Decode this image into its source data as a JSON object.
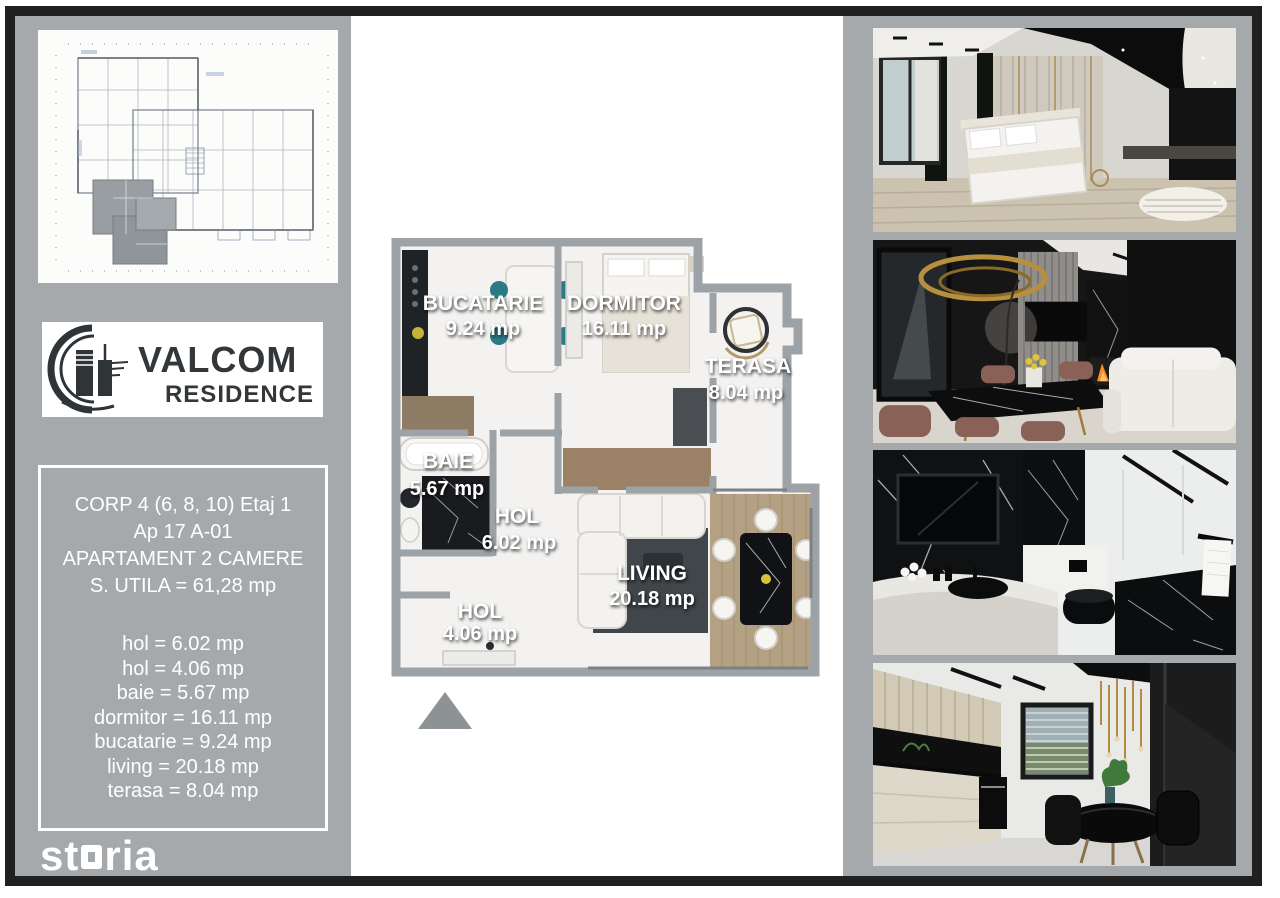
{
  "branding": {
    "logo_line1": "VALCOM",
    "logo_line2": "RESIDENCE"
  },
  "watermark": {
    "full": "storia",
    "part1": "st",
    "part2": "ria"
  },
  "info_box": {
    "line1": "CORP 4 (6, 8, 10) Etaj 1",
    "line2": "Ap 17 A-01",
    "line3": "APARTAMENT 2 CAMERE",
    "line4": "S. UTILA = 61,28 mp",
    "rooms": [
      "hol = 6.02 mp",
      "hol = 4.06 mp",
      "baie = 5.67 mp",
      "dormitor = 16.11 mp",
      "bucatarie = 9.24 mp",
      "living = 20.18 mp",
      "terasa = 8.04 mp"
    ]
  },
  "floor_plan": {
    "labels": [
      {
        "name": "BUCATARIE",
        "area": "9.24 mp"
      },
      {
        "name": "DORMITOR",
        "area": "16.11 mp"
      },
      {
        "name": "TERASA",
        "area": "8.04 mp"
      },
      {
        "name": "BAIE",
        "area": "5.67 mp"
      },
      {
        "name": "HOL",
        "area": "6.02 mp"
      },
      {
        "name": "LIVING",
        "area": "20.18 mp"
      },
      {
        "name": "HOL",
        "area": "4.06 mp"
      }
    ]
  },
  "photos": [
    {
      "name": "bedroom-render"
    },
    {
      "name": "dining-living-render"
    },
    {
      "name": "bathroom-render"
    },
    {
      "name": "kitchen-render"
    }
  ],
  "colors": {
    "panel_gray": "#a6a9ab",
    "wall_gray": "#9da2a7",
    "frame_black": "#1f201f",
    "accent_teal": "#2b7b86",
    "accent_gold": "#b5903f"
  }
}
